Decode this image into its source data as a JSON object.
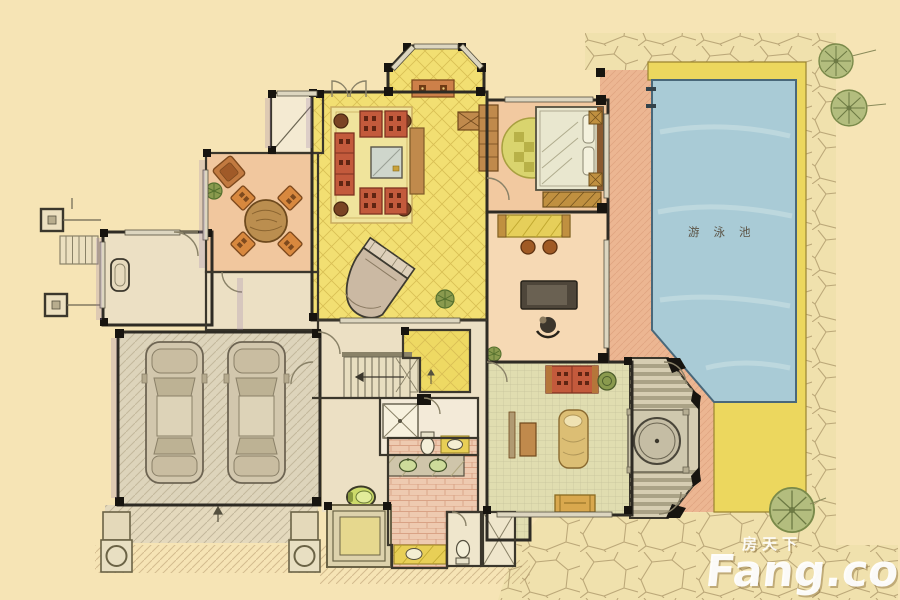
{
  "labels": {
    "pool": "游泳池"
  },
  "watermark": {
    "brand_cn": "房天下",
    "brand_en": "Fang.com"
  },
  "palette": {
    "background": "#f6e4b5",
    "stone_fill": "#f0e1ad",
    "stone_line": "#ab9668",
    "pool_water": "#a9cbd6",
    "deck_yellow": "#ecd75e",
    "deck_salmon": "#ecb692",
    "living_room": "#f2df72",
    "dining_room": "#f1c79e",
    "dining_bay": "#f4ead2",
    "bedroom": "#f2c9a0",
    "study": "#f6d9b4",
    "family_room": "#e0ddb0",
    "garage": "#ddd4bb",
    "hall": "#ece0c4",
    "yellow_room": "#eed963",
    "pink_floor": "#eecab0",
    "bath_floor": "#f3ead8",
    "octagon_deck": "#d6cdb2",
    "tree": "#b3bd7e",
    "sofa_red": "#c35a3c",
    "wood": "#c08a4c",
    "pool_label_color": "#5b5244",
    "watermark_color": "#ffffff"
  },
  "rooms": [
    {
      "id": "living-room"
    },
    {
      "id": "dining-room"
    },
    {
      "id": "bedroom"
    },
    {
      "id": "study"
    },
    {
      "id": "family-room"
    },
    {
      "id": "garage"
    },
    {
      "id": "entry"
    },
    {
      "id": "hall"
    },
    {
      "id": "bathrooms"
    },
    {
      "id": "stairs"
    },
    {
      "id": "octagon-pavilion"
    },
    {
      "id": "swimming-pool"
    },
    {
      "id": "pool-deck"
    },
    {
      "id": "stone-patio"
    },
    {
      "id": "driveway"
    }
  ]
}
